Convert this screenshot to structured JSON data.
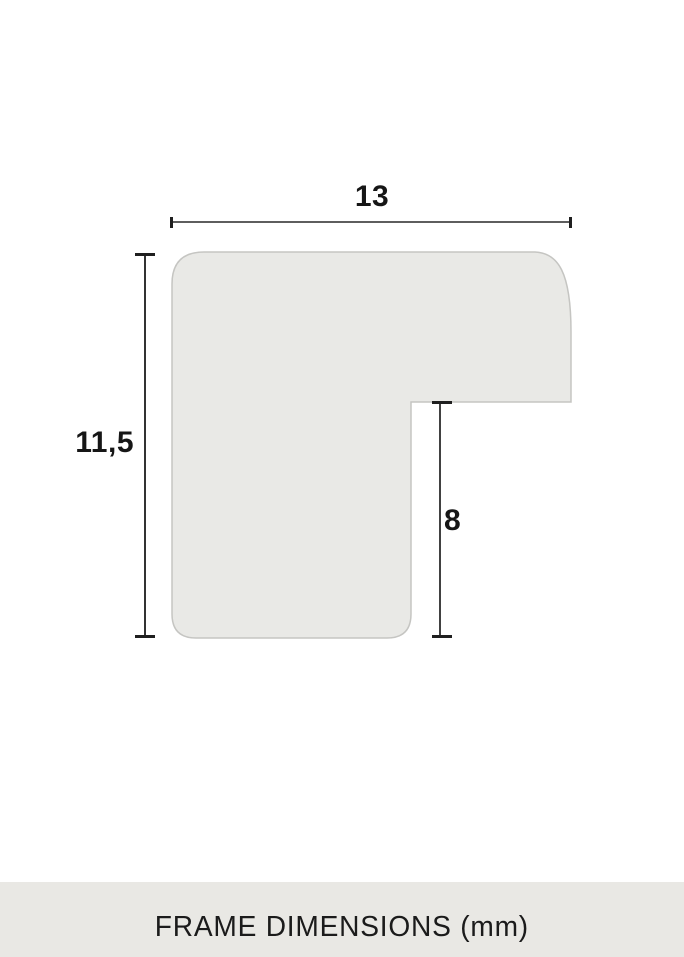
{
  "diagram": {
    "title_hint": "frame profile cross-section",
    "dimensions": {
      "width_mm": {
        "label": "13"
      },
      "height_mm": {
        "label": "11,5"
      },
      "rabbet_depth_mm": {
        "label": "8"
      }
    },
    "shape": {
      "fill": "#e9e9e6",
      "stroke": "#c5c5c2"
    },
    "line_color": "#5e5e5e",
    "tick_color": "#1f1f1f",
    "label_color": "#161616"
  },
  "footer": {
    "label": "FRAME DIMENSIONS (mm)",
    "background": "#e9e8e4",
    "text_color": "#1b1b1b"
  }
}
